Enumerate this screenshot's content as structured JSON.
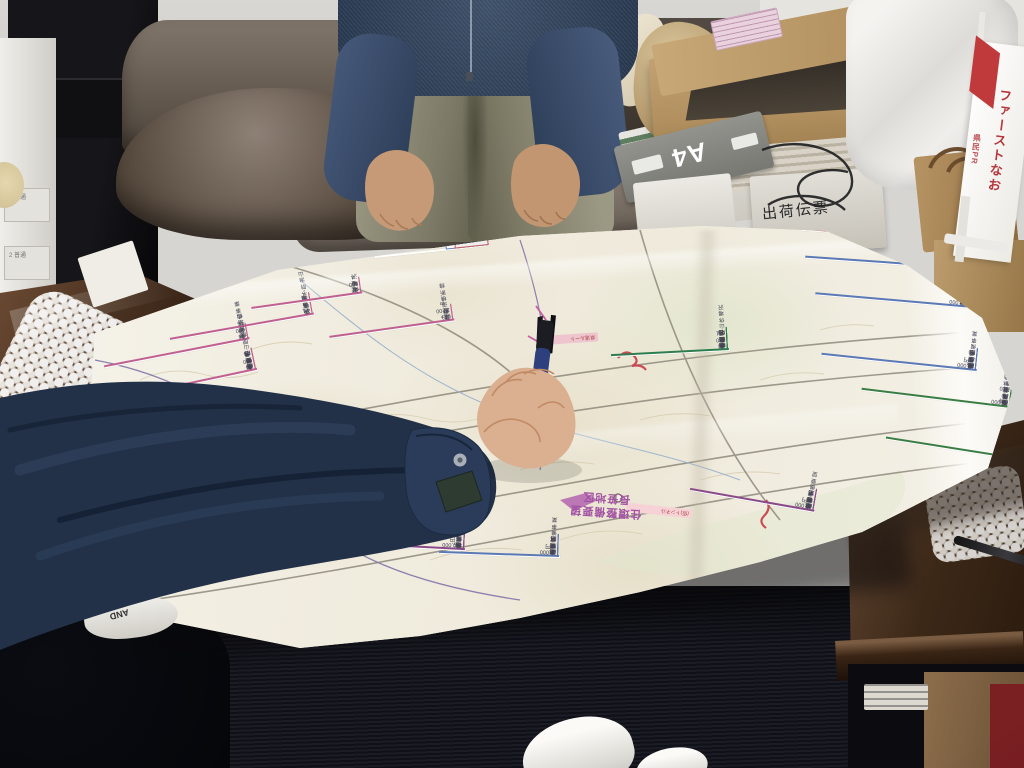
{
  "meta": {
    "type": "photograph",
    "description": "Two people lean over a large Japanese forestry and land-improvement planning map spread on a glass-topped wooden table in a cluttered office; a hand in a navy work jacket points at the map with a multicolor pen.",
    "text_orientation": "most map text faces away from the camera (appears upside down)",
    "approximate_text": true
  },
  "palette": {
    "carpet": "#15161c",
    "map_paper": "#f1eee3",
    "table_wood": "#4a3526",
    "jacket_navy": "#223147",
    "sweater_navy": "#3d5068",
    "pants_olive": "#8d8b76",
    "sofa_leather": "#6b6159",
    "cardboard": "#b2905f",
    "accent_yellow": "#f3ea52",
    "accent_pink": "#c06090",
    "accent_blue": "#5b79b5",
    "accent_green": "#3a7d44",
    "accent_red": "#c2565c",
    "accent_purple": "#8a4a8a",
    "banner_red": "#b5373c"
  },
  "office": {
    "printer_tray_labels": [
      "1 普通",
      "2 普通"
    ],
    "a4_box_label": "A4",
    "shipping_box_text": "出荷伝票",
    "banner": {
      "main_text": "ファーストなお",
      "side_text": "県民PR"
    },
    "shoe_text": "AND"
  },
  "map": {
    "district_note_line1": "住環整備要望",
    "district_note_line2": "長笹地区",
    "chips": [
      {
        "id": "route-chip",
        "x": 548,
        "y": 334,
        "w": 50,
        "rot": 176,
        "bg": "#eec4cf",
        "text": "県道ルート"
      },
      {
        "id": "tunnel-chip",
        "x": 626,
        "y": 506,
        "w": 66,
        "rot": 186,
        "bg": "#f6d2d6",
        "text": "(仮)トンネル"
      }
    ],
    "labels": [
      {
        "id": "summary-yellow",
        "type": "yellow",
        "x": 188,
        "y": 236,
        "w": 204,
        "rot": 172,
        "rows": [
          [
            "496 t",
            "流域 計",
            ""
          ],
          [
            "22 000",
            "6",
            ""
          ],
          [
            "446 100",
            "9",
            ""
          ],
          [
            "248 800",
            "8",
            ""
          ],
          [
            "264 000",
            "6",
            ""
          ],
          [
            "970 646",
            "計 11",
            ""
          ]
        ],
        "footer": "森林整備事業費 実施計画概要"
      },
      {
        "id": "legend",
        "type": "legend",
        "x": 374,
        "y": 250,
        "w": 116,
        "rot": 174,
        "legend_rows": [
          {
            "text": "県営林道整備",
            "border": "#c2565c",
            "bg": "#f7e9e9"
          },
          {
            "text": "治山事業(県営)",
            "border": "#5b79b5",
            "bg": "#ffffff"
          },
          {
            "text": "森林整備",
            "border": "#57965c",
            "bg": "#e3efe1"
          },
          {
            "text": "水源林造成",
            "border": "#5b79b5",
            "bg": "#dcebf5"
          },
          {
            "text": "その他事業",
            "border": "#c2565c",
            "bg": "#efeeee"
          }
        ]
      },
      {
        "id": "topright-red",
        "x": 802,
        "y": 234,
        "w": 150,
        "rot": 184,
        "border": "#c2565c",
        "rows": [
          [
            "新設 L=4,500 m",
            "県営林道"
          ],
          [
            "未岡〜高野線",
            "路線"
          ]
        ]
      },
      {
        "id": "right-blue-1",
        "x": 806,
        "y": 262,
        "w": 152,
        "rot": 184,
        "border": "#5b79b5",
        "rows": [
          [
            "46,000 円",
            "事業費"
          ],
          [
            "R6 〜 R9",
            "期間"
          ],
          [
            "予防治山事業",
            "事業名"
          ],
          [
            "小塩",
            "地区名"
          ]
        ]
      },
      {
        "id": "right-blue-2",
        "x": 816,
        "y": 300,
        "w": 154,
        "rot": 185,
        "border": "#5b79b5",
        "rows": [
          [
            "54,000 円",
            "事業費"
          ],
          [
            "R5 〜 R9",
            "期間"
          ],
          [
            "復旧治山事業",
            "事業名"
          ],
          [
            "高倉山",
            "地区名"
          ]
        ]
      },
      {
        "id": "right-blue-3",
        "x": 822,
        "y": 362,
        "w": 156,
        "rot": 186,
        "border": "#5b79b5",
        "rows": [
          [
            "17,000 円",
            "事業費"
          ],
          [
            "R6 〜 R8",
            "期間"
          ],
          [
            "森林整備事業",
            "事業名"
          ],
          [
            "田島",
            "地区名"
          ]
        ]
      },
      {
        "id": "right-green",
        "x": 862,
        "y": 398,
        "w": 150,
        "rot": 187,
        "border": "#3a7d44",
        "rows": [
          [
            "34,000",
            "事業費"
          ],
          [
            "R4 〜 R10",
            "期間"
          ],
          [
            "(仮)水源林造成",
            "事業名"
          ],
          [
            "横川国有林",
            "箇所"
          ]
        ]
      },
      {
        "id": "bottomright-green",
        "x": 886,
        "y": 448,
        "w": 132,
        "rot": 189,
        "border": "#3a7d44",
        "rows": [
          [
            "24,000 円",
            "事業費"
          ],
          [
            "R4 〜 R10",
            "期間"
          ],
          [
            "水源林造成事業",
            "事業名"
          ],
          [
            "田代山",
            "地区名"
          ]
        ]
      },
      {
        "id": "center-green",
        "x": 612,
        "y": 352,
        "w": 118,
        "rot": 177,
        "border": "#2e7d4f",
        "rows": [
          [
            "44 000 001",
            "事業費"
          ],
          [
            "R4 〜 R9",
            "期間"
          ],
          [
            "復旧治山 休場沢",
            "事業名"
          ],
          [
            "中組",
            "地区名"
          ]
        ]
      },
      {
        "id": "pink-left-a",
        "x": 170,
        "y": 326,
        "w": 146,
        "rot": 170,
        "border": "#c06090",
        "rows": [
          [
            "学校裏 予防治山",
            "海富田"
          ],
          [
            "4.1 治山",
            "大桑原"
          ]
        ]
      },
      {
        "id": "pink-left-b",
        "x": 104,
        "y": 352,
        "w": 148,
        "rot": 169,
        "border": "#c06090",
        "rows": [
          [
            "14 000 6",
            "明戸"
          ],
          [
            "予防治山事業",
            "宮本"
          ]
        ]
      },
      {
        "id": "pink-left-c",
        "x": 92,
        "y": 386,
        "w": 168,
        "rot": 168,
        "border": "#c06090",
        "rows": [
          [
            "34 000 9",
            "事業費"
          ],
          [
            "R6 〜 R9",
            "期間"
          ],
          [
            "県営中山間総合整備",
            "事業名"
          ],
          [
            "上野尻",
            "地区名"
          ]
        ]
      },
      {
        "id": "pink-mid-1",
        "x": 252,
        "y": 300,
        "w": 112,
        "rot": 172,
        "border": "#c06090",
        "rows": [
          [
            "12 000 4",
            "治山"
          ],
          [
            "休場沢",
            "堰堤"
          ]
        ]
      },
      {
        "id": "pink-mid-2",
        "x": 330,
        "y": 328,
        "w": 126,
        "rot": 172,
        "border": "#c06090",
        "rows": [
          [
            "(仮)林道横断線",
            "改良"
          ],
          [
            "L= 1,200 m",
            "新設"
          ]
        ]
      },
      {
        "id": "bottom-purple",
        "x": 344,
        "y": 546,
        "w": 122,
        "rot": 183,
        "border": "#8a4a8a",
        "rows": [
          [
            "120,000 円",
            "事業費"
          ],
          [
            "R5 − R12",
            "期間"
          ],
          [
            "ため池等整備 (県営防災)",
            "事業名"
          ],
          [
            "相包取田",
            "地区名"
          ]
        ]
      },
      {
        "id": "bottom-blue",
        "x": 440,
        "y": 554,
        "w": 120,
        "rot": 182,
        "border": "#5b79b5",
        "rows": [
          [
            "11,000 円",
            "事業費"
          ],
          [
            "R7 〜",
            "期間"
          ],
          [
            "ほ場整備事業",
            "事業名"
          ],
          [
            "上野田",
            "地区名"
          ]
        ]
      },
      {
        "id": "curl-purple",
        "x": 690,
        "y": 500,
        "w": 126,
        "rot": 190,
        "border": "#8a4a8a",
        "rows": [
          [
            "17,000 円",
            "事業費"
          ],
          [
            "R7 予定",
            "期間"
          ],
          [
            "ほ場整備要望",
            "事業名"
          ],
          [
            "長笹",
            "地区名"
          ]
        ]
      }
    ]
  }
}
